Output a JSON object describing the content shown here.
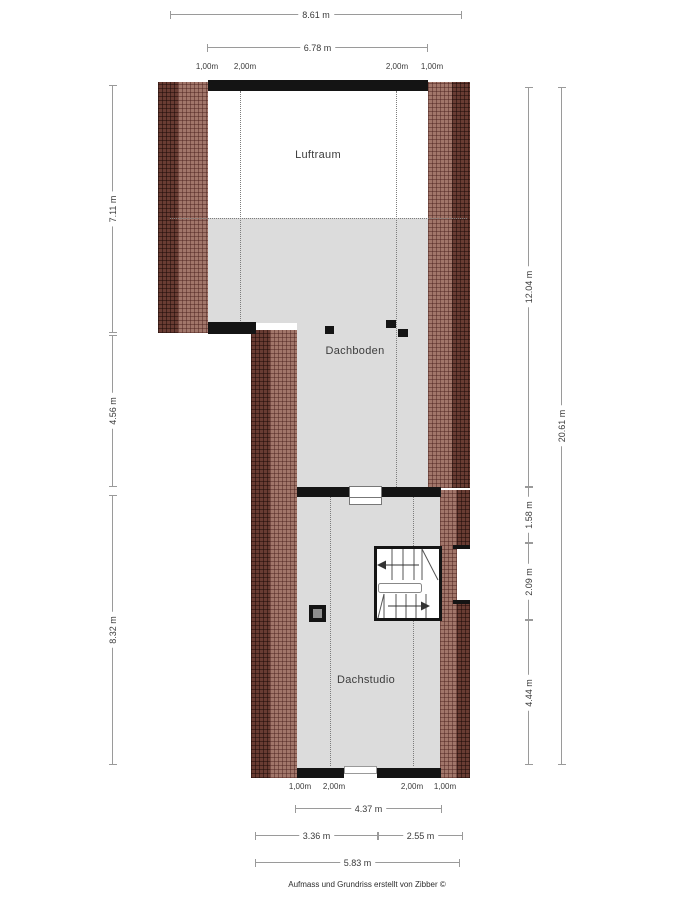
{
  "rooms": {
    "luftraum": "Luftraum",
    "dachboden": "Dachboden",
    "dachstudio": "Dachstudio"
  },
  "dims": {
    "width_total": "8.61 m",
    "width_inner": "6.78 m",
    "left_upper": "7.11 m",
    "left_middle": "4.56 m",
    "left_lower": "8.32 m",
    "right_dachboden": "12.04 m",
    "right_total": "20.61 m",
    "right_seg1": "1.58 m",
    "right_seg2": "2.09 m",
    "right_seg3": "4.44 m",
    "bottom_inner": "4.37 m",
    "bottom_left": "3.36 m",
    "bottom_right": "2.55 m",
    "bottom_total": "5.83 m",
    "marks_top": [
      "1,00m",
      "2,00m",
      "2,00m",
      "1,00m"
    ],
    "marks_bottom": [
      "1,00m",
      "2,00m",
      "2,00m",
      "1,00m"
    ]
  },
  "footer": "Aufmass und Grundriss erstellt von Zibber ©",
  "colors": {
    "floor": "#dcdcdc",
    "wall_light": "#a1766a",
    "wall_dark": "#693c33",
    "structure": "#141414"
  }
}
